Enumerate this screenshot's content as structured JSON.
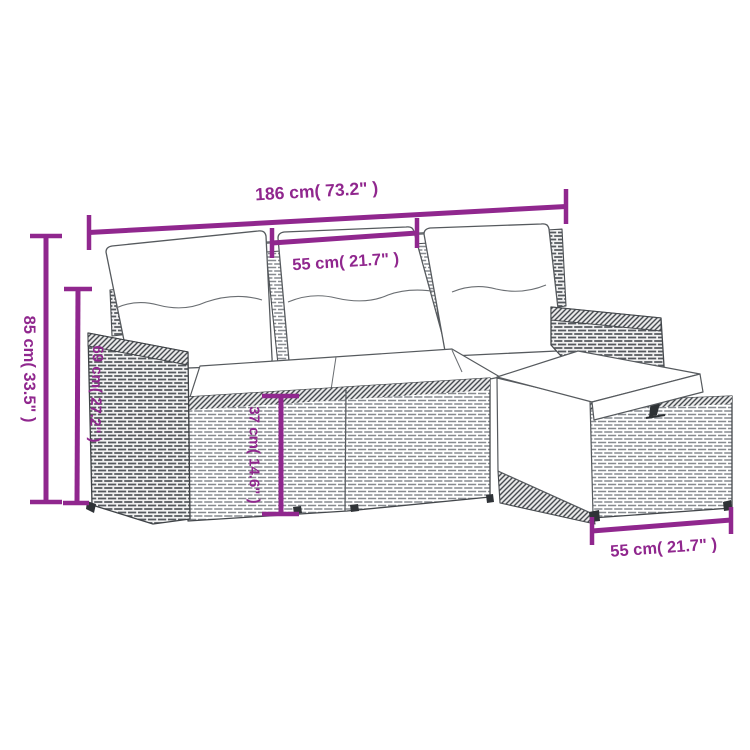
{
  "meta": {
    "subject": "Dimension diagram of a poly rattan garden sofa set (3-seater sofa with back cushions, seat cushions and storage ottoman)"
  },
  "colors": {
    "dimension_accent": "#90278e",
    "line_art_outline": "#44484c",
    "rattan_gray": "#878b90",
    "cushion_white": "#ffffff",
    "background": "#ffffff"
  },
  "dimension_labels": {
    "overall_width": "186 cm( 73.2\" )",
    "seat_width": "55 cm( 21.7\" )",
    "overall_height": "85 cm( 33.5\" )",
    "back_height": "69 cm( 27.2\" )",
    "seat_height": "37 cm( 14.6\" )",
    "ottoman_width": "55 cm( 21.7\" )"
  }
}
